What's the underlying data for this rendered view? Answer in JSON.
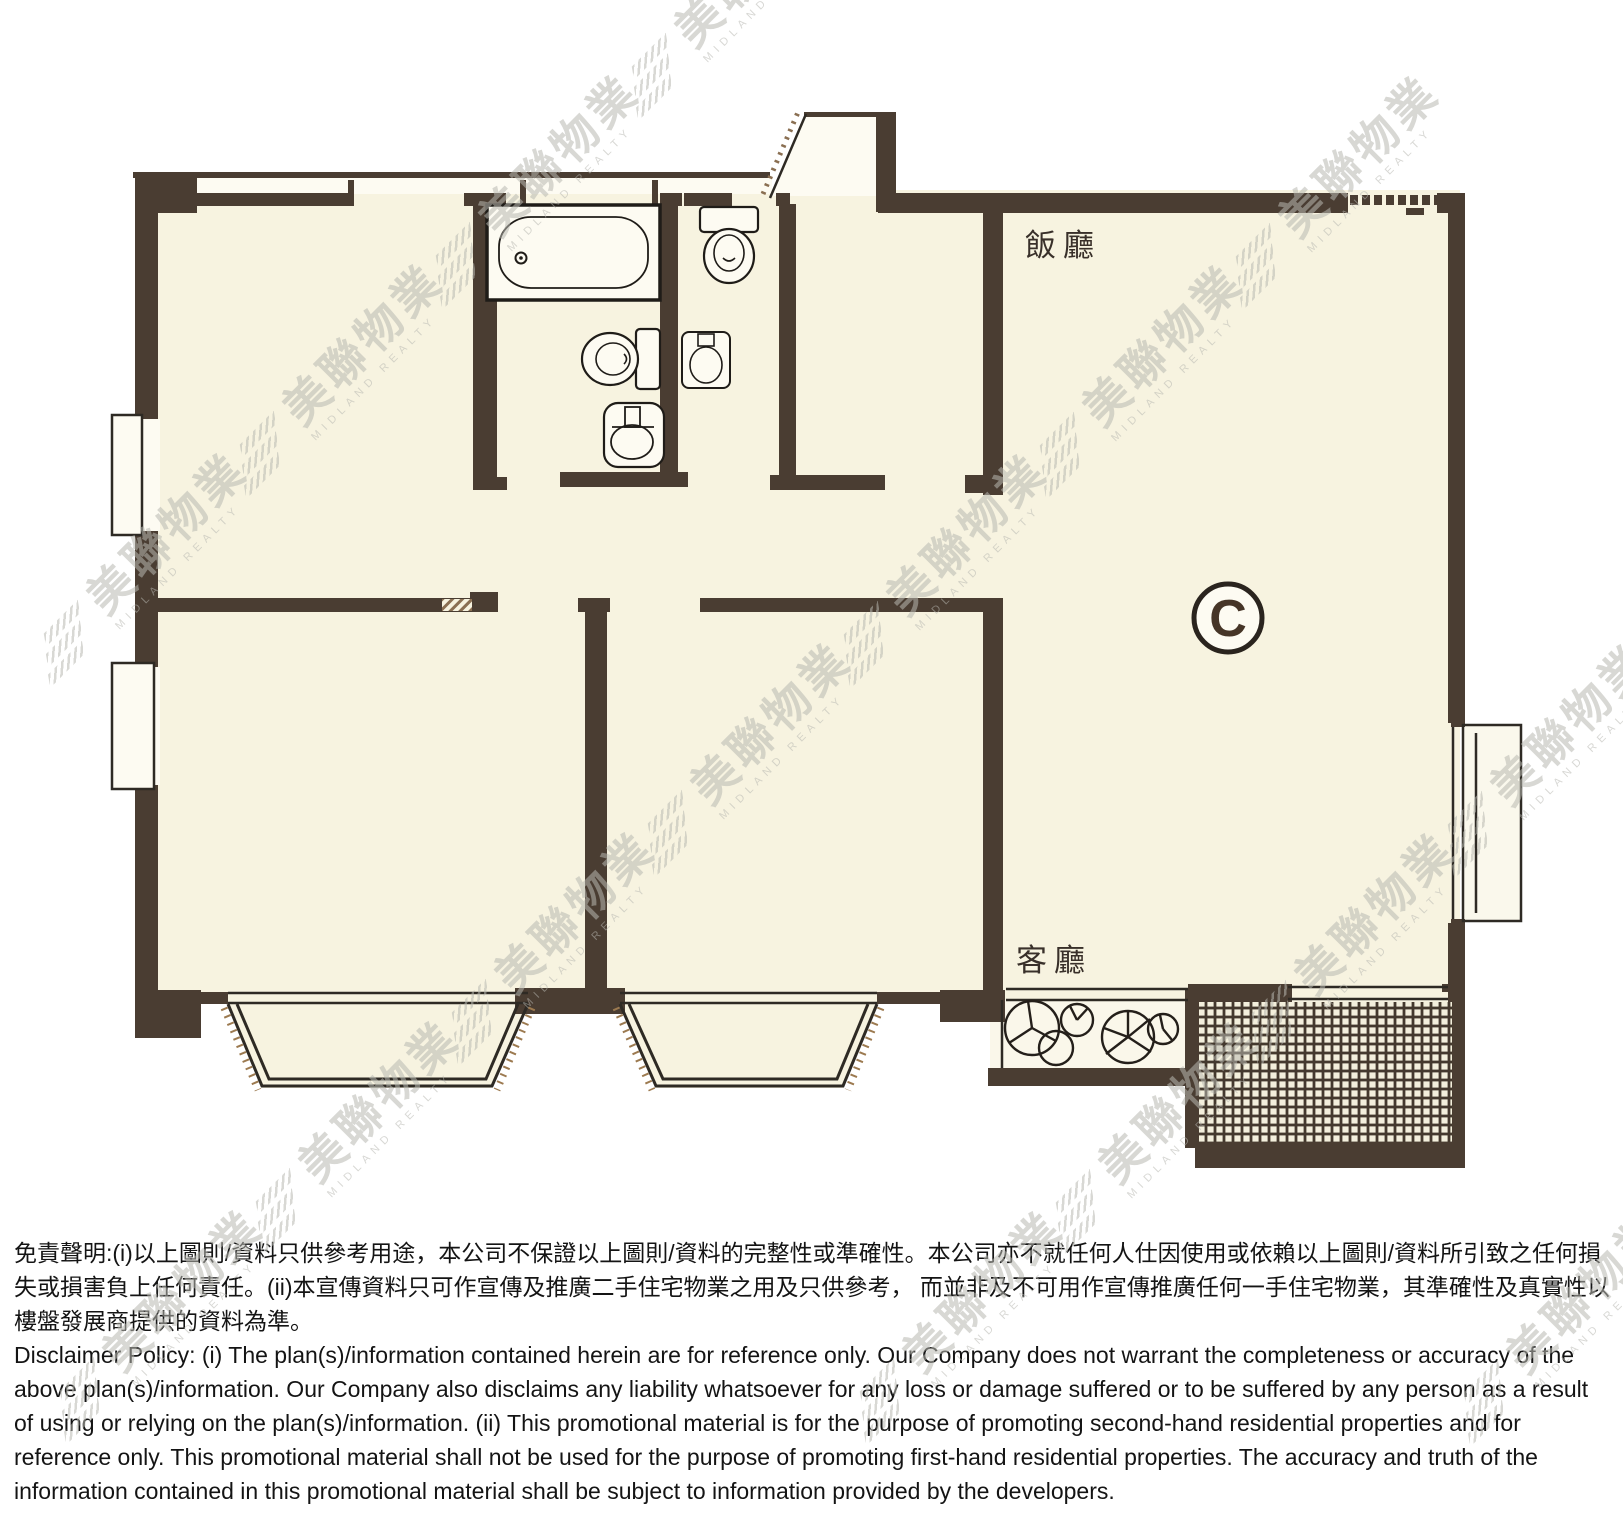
{
  "page": {
    "background_color": "#ffffff"
  },
  "floor_plan": {
    "unit_marker": "C",
    "labels": {
      "dining_room": "飯廳",
      "living_room": "客廳"
    },
    "colors": {
      "wall": "#4a3d32",
      "floor": "#f7f3e0",
      "fixture_outline": "#1f1c18"
    }
  },
  "watermark": {
    "brand_cn": "美聯物業",
    "brand_en": "MIDLAND REALTY",
    "color": "#b7b7b1"
  },
  "disclaimer": {
    "zh": "免責聲明:(i)以上圖則/資料只供參考用途，本公司不保證以上圖則/資料的完整性或準確性。本公司亦不就任何人仕因使用或依賴以上圖則/資料所引致之任何損失或損害負上任何責任。(ii)本宣傳資料只可作宣傳及推廣二手住宅物業之用及只供參考， 而並非及不可用作宣傳推廣任何一手住宅物業，其準確性及真實性以樓盤發展商提供的資料為準。",
    "en": "Disclaimer Policy: (i) The plan(s)/information contained herein are for reference only. Our Company does not warrant the completeness or accuracy of the above plan(s)/information. Our Company also disclaims any liability whatsoever for any loss or damage suffered or to be suffered by any person as a result of using or relying on the plan(s)/information. (ii) This promotional material is for the purpose of promoting second-hand residential properties and for reference only. This promotional material shall not be used for the purpose of promoting first-hand residential properties. The accuracy and truth of the information contained in this promotional material shall be subject to information provided by the developers."
  }
}
